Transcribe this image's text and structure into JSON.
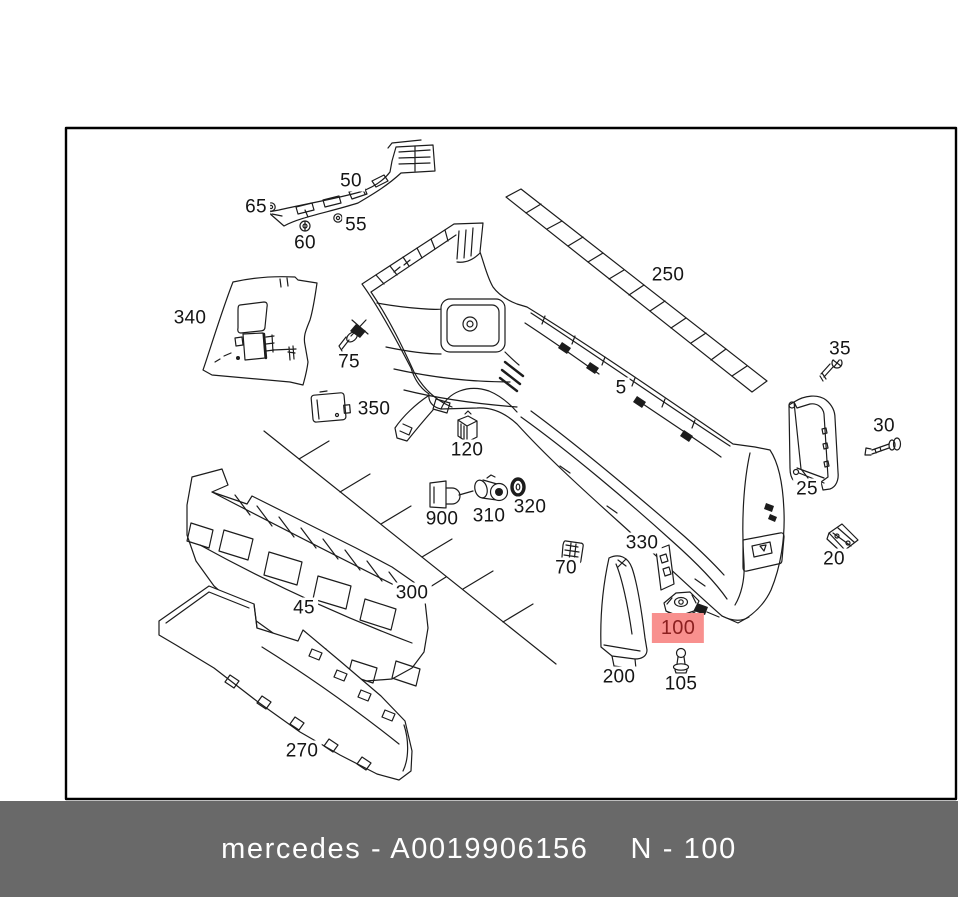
{
  "footer": {
    "left_text": "mercedes - A0019906156",
    "right_text": "N - 100"
  },
  "highlight": {
    "selected_part": "100"
  },
  "colors": {
    "footer_bg": "#696969",
    "footer_text": "#ffffff",
    "highlight_bg": "#f8908e",
    "highlight_text": "#8b1f1f",
    "line": "#1c1c1c",
    "border": "#000000",
    "page_bg": "#ffffff"
  },
  "parts": {
    "p5": "5",
    "p20": "20",
    "p25": "25",
    "p30": "30",
    "p35": "35",
    "p45": "45",
    "p50": "50",
    "p55": "55",
    "p60": "60",
    "p65": "65",
    "p70": "70",
    "p75": "75",
    "p100": "100",
    "p105": "105",
    "p120": "120",
    "p200": "200",
    "p250": "250",
    "p270": "270",
    "p300": "300",
    "p310": "310",
    "p320": "320",
    "p330": "330",
    "p340": "340",
    "p350": "350",
    "p900": "900"
  }
}
